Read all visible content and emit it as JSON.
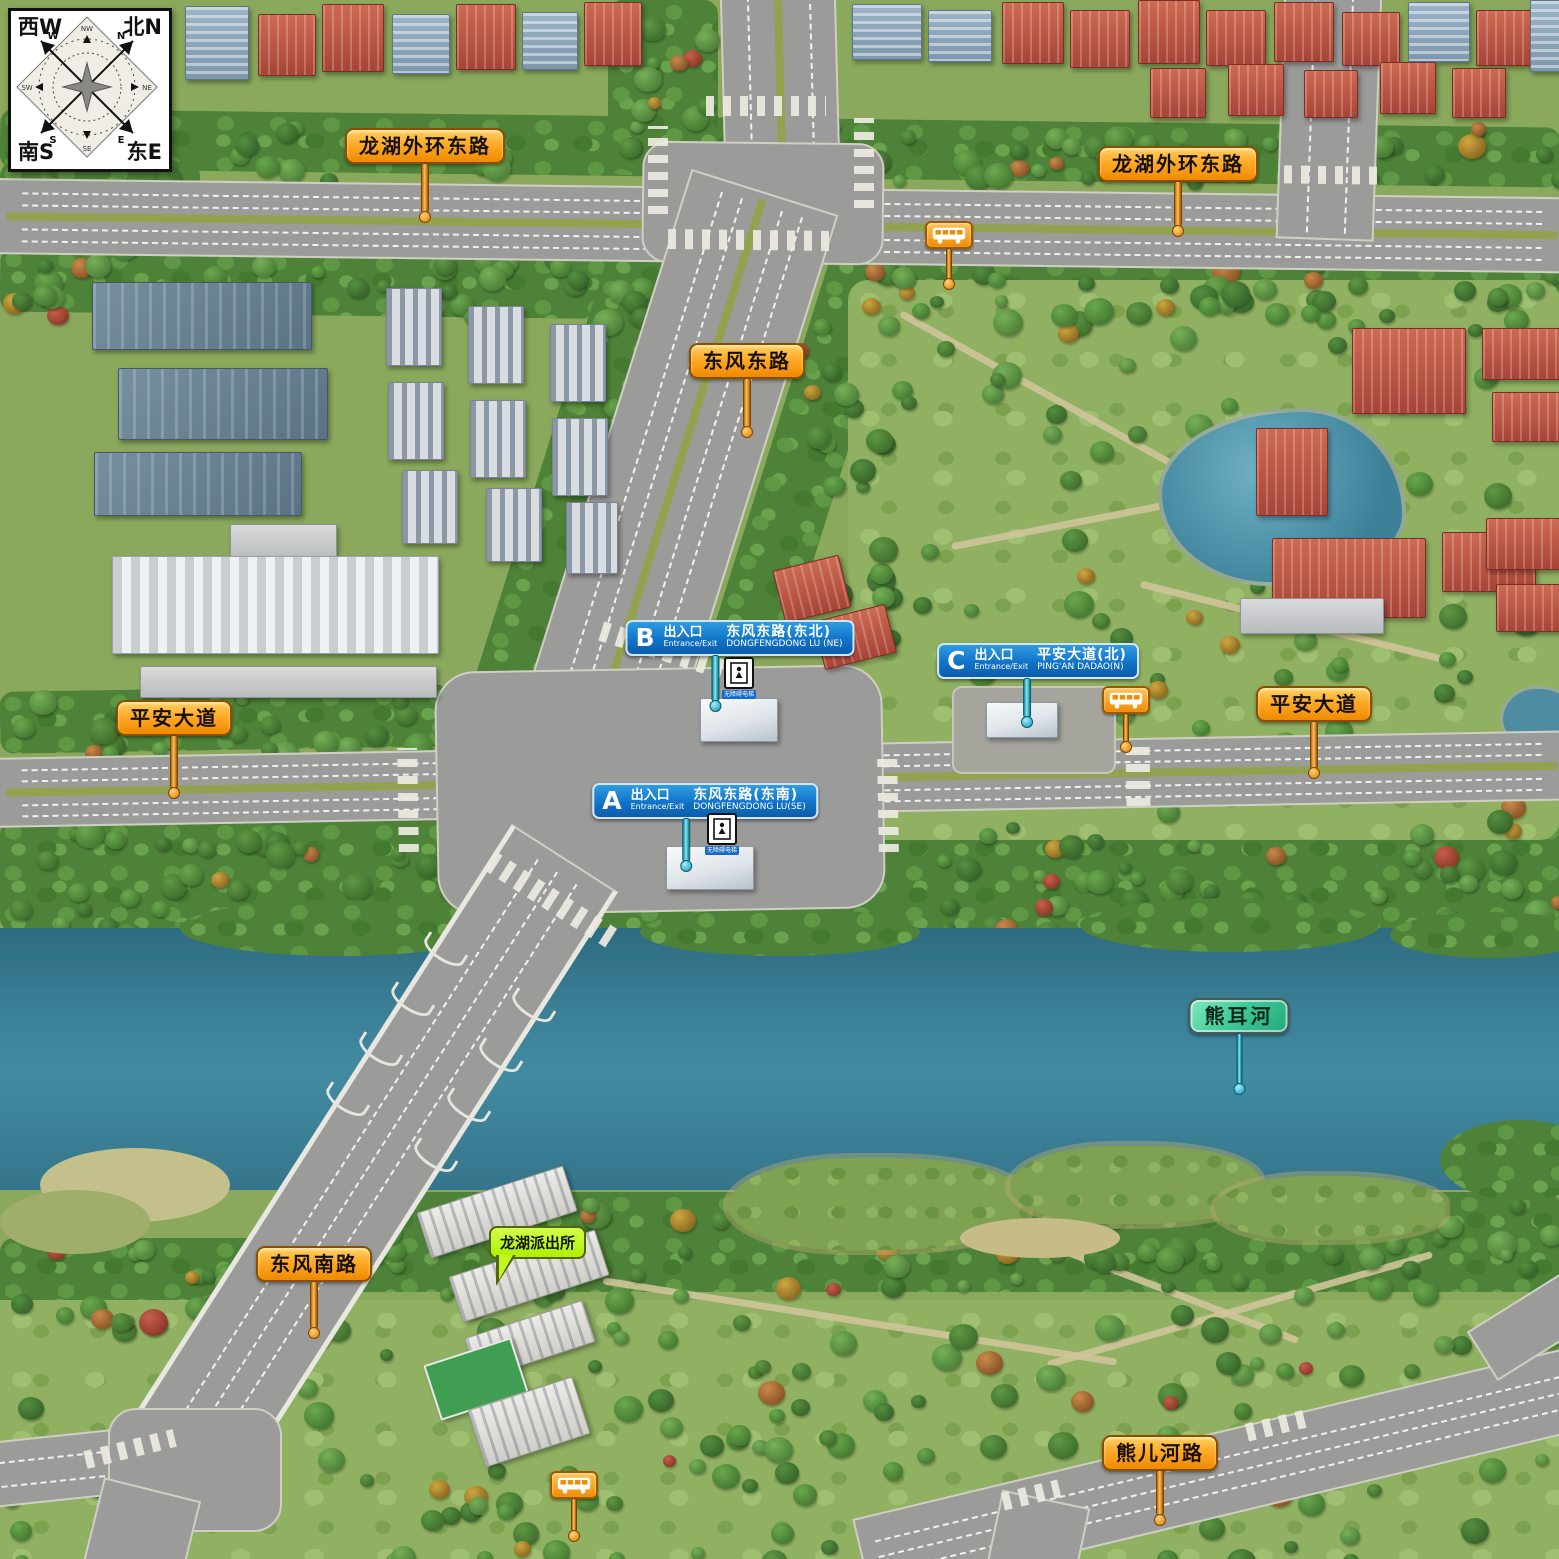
{
  "compass": {
    "corner_nw": "西W",
    "corner_ne": "北N",
    "corner_sw": "南S",
    "corner_se": "东E",
    "arrow_nw": "W",
    "arrow_ne": "N",
    "arrow_sw": "S",
    "arrow_se": "E",
    "minor_up": "NW",
    "minor_right": "NE",
    "minor_down": "SE",
    "minor_left": "SW"
  },
  "road_signs": {
    "longhu_outer_east_1": "龙湖外环东路",
    "longhu_outer_east_2": "龙湖外环东路",
    "dongfeng_east": "东风东路",
    "pingan_avenue_1": "平安大道",
    "pingan_avenue_2": "平安大道",
    "dongfeng_south": "东风南路",
    "xiongerhe_road": "熊儿河路"
  },
  "river_sign": "熊耳河",
  "police_callout": "龙湖派出所",
  "entrances": [
    {
      "letter": "A",
      "label_cn": "出入口",
      "label_en": "Entrance/Exit",
      "road_cn": "东风东路(东南)",
      "road_en": "DONGFENGDONG LU(SE)"
    },
    {
      "letter": "B",
      "label_cn": "出入口",
      "label_en": "Entrance/Exit",
      "road_cn": "东风东路(东北)",
      "road_en": "DONGFENGDONG LU (NE)"
    },
    {
      "letter": "C",
      "label_cn": "出入口",
      "label_en": "Entrance/Exit",
      "road_cn": "平安大道(北)",
      "road_en": "PING'AN DADAO(N)"
    }
  ],
  "accessibility_label": "无障碍电梯",
  "icons": {
    "bus_stop": "bus-stop-icon",
    "accessible_elevator": "accessible-elevator-icon",
    "compass": "compass-rose-icon"
  },
  "colors": {
    "road_sign_orange": "#F59B1E",
    "entrance_sign_blue": "#1173C8",
    "river_sign_green": "#3FC495",
    "police_callout_green": "#B6F000",
    "pole_teal": "#2FB9D8",
    "river_water": "#3A7F96",
    "road_gray": "#9B9B99",
    "grass_green": "#8AA95C"
  }
}
